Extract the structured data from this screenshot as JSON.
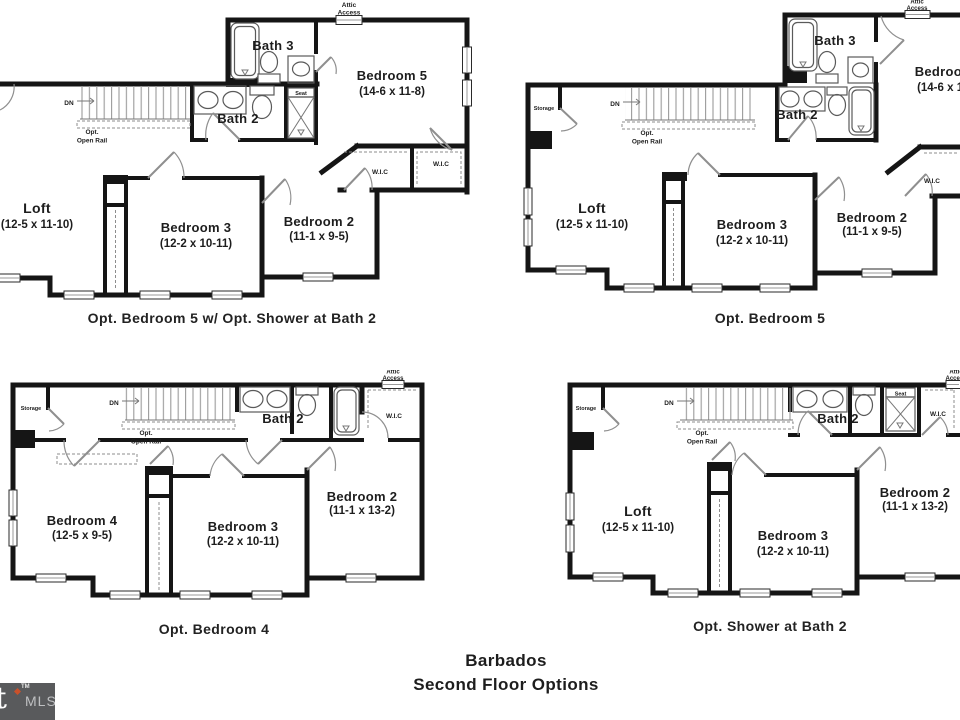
{
  "colors": {
    "wall": "#151515",
    "text": "#1d1d1d",
    "watermark_bg": "#595a5c",
    "watermark_text": "#bfc0c2",
    "watermark_accent": "#c9512b"
  },
  "footer": {
    "title": "Barbados",
    "subtitle": "Second Floor Options"
  },
  "watermark": {
    "glyph": "t",
    "trademark": "TM",
    "label": "MLS"
  },
  "plans": {
    "top_left": {
      "caption": "Opt. Bedroom 5 w/ Opt. Shower at Bath 2",
      "attic_line1": "Attic",
      "attic_line2": "Access",
      "dn": "DN",
      "rail_line1": "Opt.",
      "rail_line2": "Open Rail",
      "seat": "Seat",
      "bath3": "Bath 3",
      "bedroom5_name": "Bedroom 5",
      "bedroom5_dims": "(14-6 x 11-8)",
      "bath2": "Bath 2",
      "wic1": "W.I.C",
      "wic2": "W.I.C",
      "loft_name": "Loft",
      "loft_dims": "(12-5 x 11-10)",
      "bedroom3_name": "Bedroom 3",
      "bedroom3_dims": "(12-2 x 10-11)",
      "bedroom2_name": "Bedroom 2",
      "bedroom2_dims": "(11-1 x 9-5)"
    },
    "top_right": {
      "caption": "Opt. Bedroom 5",
      "attic_line1": "Attic",
      "attic_line2": "Access",
      "storage": "Storage",
      "dn": "DN",
      "rail_line1": "Opt.",
      "rail_line2": "Open Rail",
      "bath3": "Bath 3",
      "bedroom5_name": "Bedroom 5",
      "bedroom5_dims": "(14-6 x 11-8)",
      "bath2": "Bath 2",
      "wic": "W.I.C",
      "loft_name": "Loft",
      "loft_dims": "(12-5 x 11-10)",
      "bedroom3_name": "Bedroom 3",
      "bedroom3_dims": "(12-2 x 10-11)",
      "bedroom2_name": "Bedroom 2",
      "bedroom2_dims": "(11-1 x 9-5)"
    },
    "bottom_left": {
      "caption": "Opt. Bedroom 4",
      "attic_line1": "Attic",
      "attic_line2": "Access",
      "storage": "Storage",
      "dn": "DN",
      "rail_line1": "Opt.",
      "rail_line2": "Open Rail",
      "bath2": "Bath 2",
      "wic": "W.I.C",
      "bedroom4_name": "Bedroom 4",
      "bedroom4_dims": "(12-5 x 9-5)",
      "bedroom3_name": "Bedroom 3",
      "bedroom3_dims": "(12-2 x 10-11)",
      "bedroom2_name": "Bedroom 2",
      "bedroom2_dims": "(11-1 x 13-2)"
    },
    "bottom_right": {
      "caption": "Opt. Shower at Bath 2",
      "attic_line1": "Attic",
      "attic_line2": "Access",
      "storage": "Storage",
      "dn": "DN",
      "rail_line1": "Opt.",
      "rail_line2": "Open Rail",
      "seat": "Seat",
      "bath2": "Bath 2",
      "wic": "W.I.C",
      "loft_name": "Loft",
      "loft_dims": "(12-5 x 11-10)",
      "bedroom3_name": "Bedroom 3",
      "bedroom3_dims": "(12-2 x 10-11)",
      "bedroom2_name": "Bedroom 2",
      "bedroom2_dims": "(11-1 x 13-2)"
    }
  }
}
